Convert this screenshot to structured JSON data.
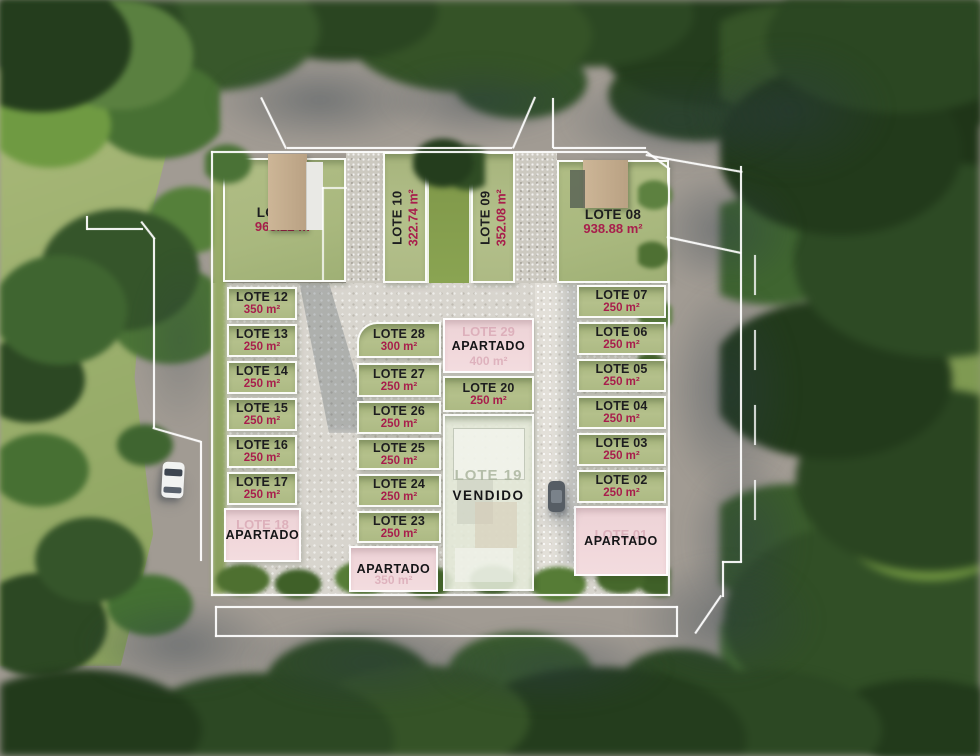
{
  "palette": {
    "asphalt": "#a19b93",
    "courtyard": "#d8d5ce",
    "lot_green": "#b4c08b",
    "lot_green_dark": "#a6b47c",
    "lot_pink": "#f1d8db",
    "sold_pale": "#e4e9d8",
    "name_text": "#1d1d1f",
    "area_text": "#a81e4c",
    "ghost_pink": "#cf93a4",
    "ghost_gray": "#a7b29a",
    "meadow": "#9cb06e",
    "forest_dark": "#2c4823",
    "roof_tan": "#c3ab8d"
  },
  "top_row": [
    {
      "name": "LOTE 11",
      "area": "968.22 m²"
    },
    {
      "name": "LOTE 10",
      "area": "322.74 m²"
    },
    {
      "name": "LOTE 09",
      "area": "352.08 m²"
    },
    {
      "name": "LOTE 08",
      "area": "938.88 m²"
    }
  ],
  "left_column": {
    "lots": [
      {
        "name": "LOTE 12",
        "area": "350 m²"
      },
      {
        "name": "LOTE 13",
        "area": "250 m²"
      },
      {
        "name": "LOTE 14",
        "area": "250 m²"
      },
      {
        "name": "LOTE 15",
        "area": "250 m²"
      },
      {
        "name": "LOTE 16",
        "area": "250 m²"
      },
      {
        "name": "LOTE 17",
        "area": "250 m²"
      }
    ],
    "apartado": {
      "ghost_name": "LOTE 18",
      "label": "APARTADO"
    }
  },
  "middle_column": {
    "lots": [
      {
        "name": "LOTE 28",
        "area": "300 m²"
      },
      {
        "name": "LOTE 27",
        "area": "250 m²"
      },
      {
        "name": "LOTE 26",
        "area": "250 m²"
      },
      {
        "name": "LOTE 25",
        "area": "250 m²"
      },
      {
        "name": "LOTE 24",
        "area": "250 m²"
      },
      {
        "name": "LOTE 23",
        "area": "250 m²"
      }
    ],
    "apartado": {
      "label": "APARTADO",
      "ghost_area": "350 m²"
    }
  },
  "center_block": {
    "lote_29": {
      "ghost_name": "LOTE 29",
      "label": "APARTADO",
      "ghost_area": "400 m²"
    },
    "lote_20": {
      "name": "LOTE 20",
      "area": "250 m²"
    },
    "lote_19": {
      "ghost_name": "LOTE 19",
      "label": "VENDIDO"
    }
  },
  "right_column": {
    "lots": [
      {
        "name": "LOTE 07",
        "area": "250 m²"
      },
      {
        "name": "LOTE 06",
        "area": "250 m²"
      },
      {
        "name": "LOTE 05",
        "area": "250 m²"
      },
      {
        "name": "LOTE 04",
        "area": "250 m²"
      },
      {
        "name": "LOTE 03",
        "area": "250 m²"
      },
      {
        "name": "LOTE 02",
        "area": "250 m²"
      }
    ],
    "apartado": {
      "ghost_name": "LOTE 01",
      "label": "APARTADO"
    }
  }
}
